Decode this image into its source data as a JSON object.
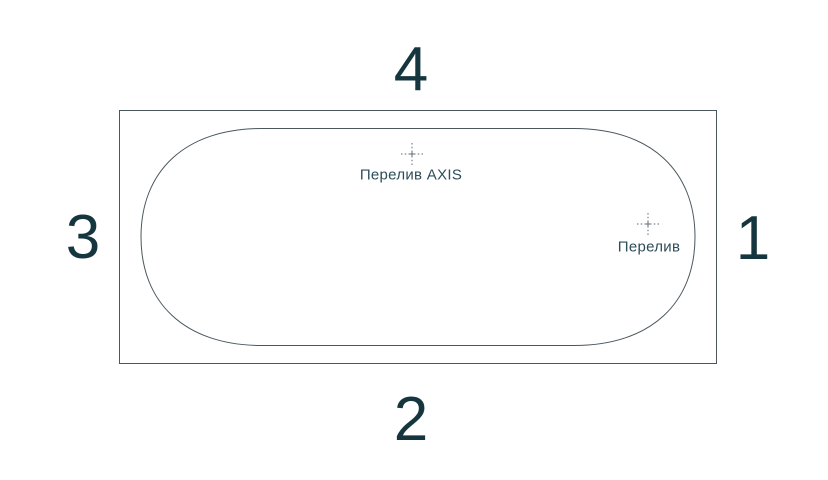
{
  "diagram": {
    "description": "bathtub-top-view-schematic",
    "side_numbers": {
      "top": "4",
      "bottom": "2",
      "left": "3",
      "right": "1"
    },
    "markers": [
      {
        "label": "Перелив AXIS"
      },
      {
        "label": "Перелив"
      }
    ],
    "colors": {
      "background": "#ffffff",
      "outline": "#4a575d",
      "tub_outline": "#4a575d",
      "center_mark": "#5f6d73",
      "number_text": "#16363f",
      "label_text": "#2d4d59"
    }
  }
}
